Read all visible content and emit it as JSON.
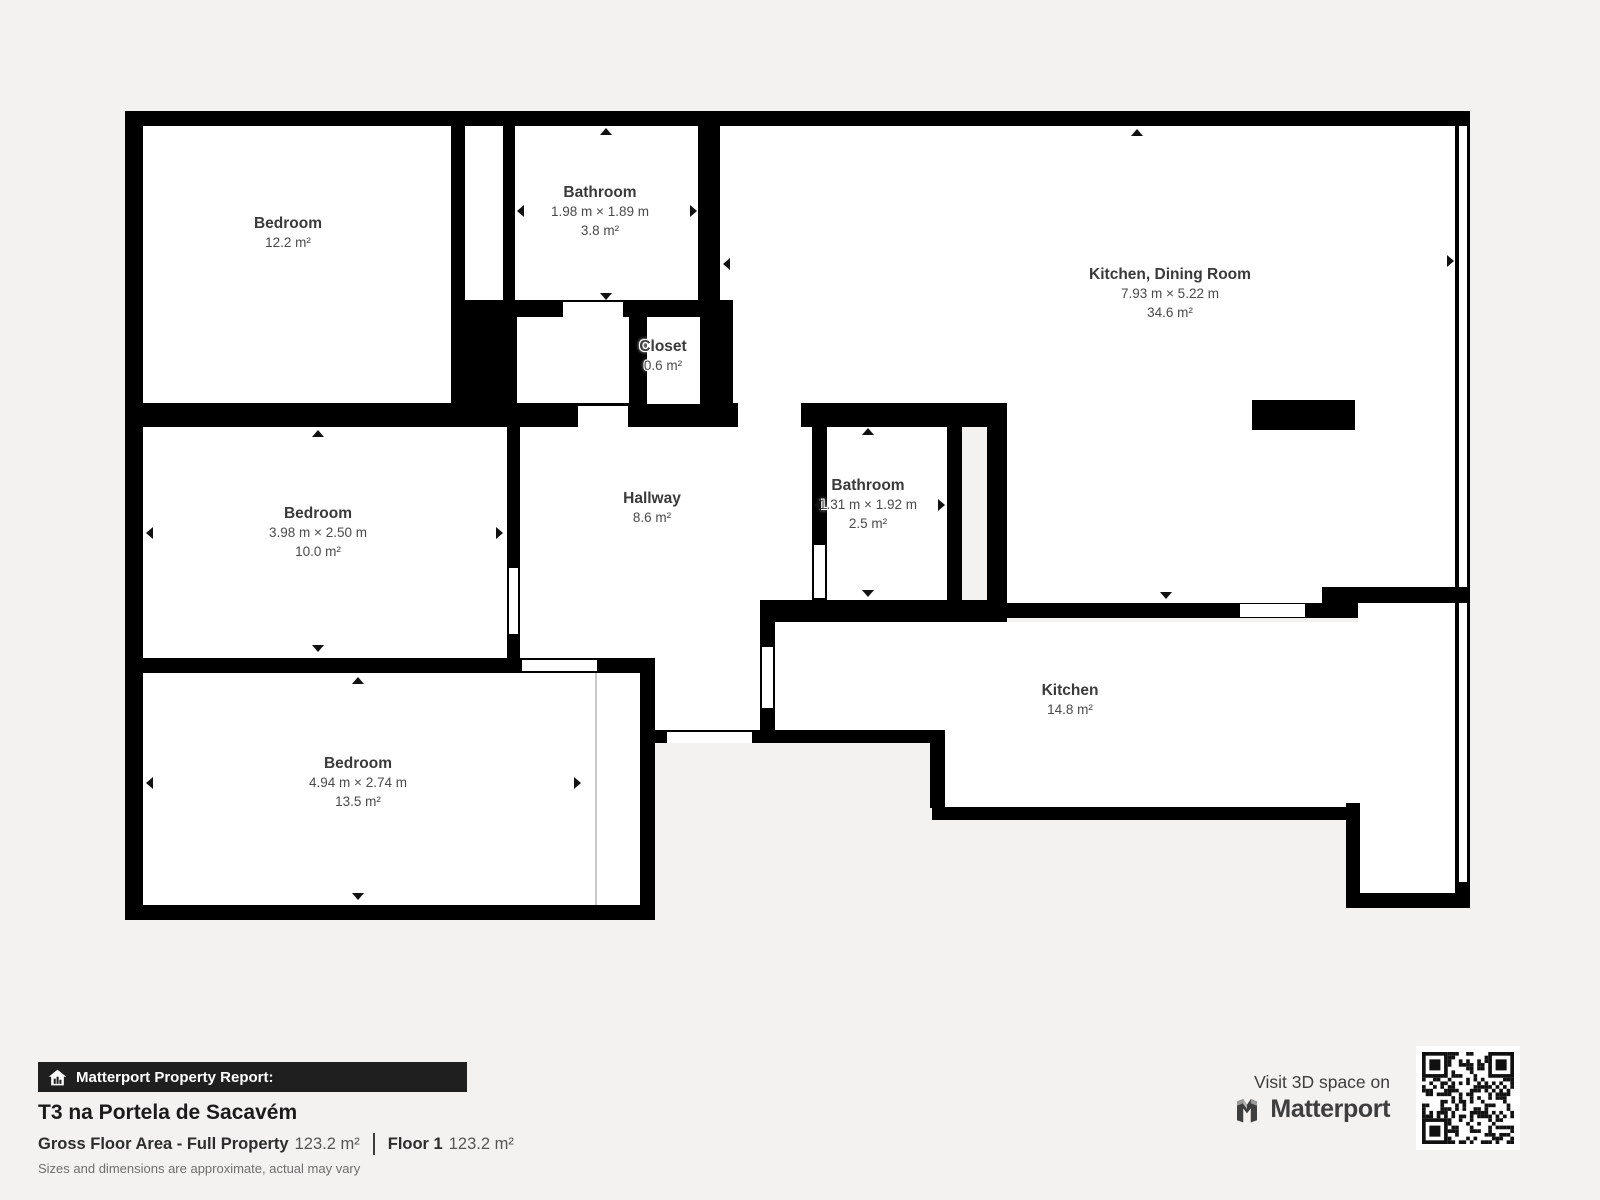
{
  "page": {
    "background": "#f3f2f0"
  },
  "floorplan": {
    "wall_color": "#000000",
    "room_color": "#ffffff",
    "partition_color": "#c9c9c9",
    "rooms": [
      [
        143,
        126,
        308,
        277
      ],
      [
        465,
        126,
        38,
        174
      ],
      [
        515,
        126,
        183,
        174
      ],
      [
        517,
        317,
        112,
        86
      ],
      [
        720,
        126,
        735,
        277
      ],
      [
        1007,
        403,
        448,
        200
      ],
      [
        143,
        427,
        364,
        231
      ],
      [
        520,
        427,
        292,
        173
      ],
      [
        520,
        600,
        240,
        58
      ],
      [
        655,
        658,
        105,
        72
      ],
      [
        827,
        427,
        120,
        173
      ],
      [
        143,
        673,
        497,
        232
      ],
      [
        775,
        622,
        680,
        108
      ],
      [
        945,
        730,
        510,
        77
      ],
      [
        1360,
        807,
        95,
        86
      ],
      [
        1358,
        602,
        97,
        20
      ],
      [
        1459,
        126,
        8,
        756
      ]
    ],
    "walls": [
      [
        125,
        111,
        1345,
        15
      ],
      [
        125,
        111,
        18,
        809
      ],
      [
        451,
        126,
        14,
        277
      ],
      [
        503,
        126,
        12,
        174
      ],
      [
        698,
        126,
        22,
        174
      ],
      [
        451,
        300,
        282,
        17
      ],
      [
        451,
        317,
        66,
        86
      ],
      [
        629,
        317,
        18,
        86
      ],
      [
        700,
        300,
        33,
        127
      ],
      [
        125,
        403,
        882,
        24
      ],
      [
        507,
        427,
        13,
        231
      ],
      [
        125,
        658,
        530,
        15
      ],
      [
        640,
        673,
        15,
        247
      ],
      [
        125,
        905,
        530,
        15
      ],
      [
        812,
        427,
        15,
        173
      ],
      [
        947,
        427,
        15,
        173
      ],
      [
        987,
        403,
        20,
        219
      ],
      [
        760,
        600,
        15,
        143
      ],
      [
        760,
        600,
        247,
        22
      ],
      [
        1007,
        603,
        351,
        15
      ],
      [
        1322,
        587,
        148,
        16
      ],
      [
        655,
        730,
        290,
        13
      ],
      [
        930,
        743,
        15,
        65
      ],
      [
        932,
        807,
        428,
        13
      ],
      [
        1346,
        803,
        14,
        92
      ],
      [
        1346,
        893,
        124,
        15
      ],
      [
        1455,
        126,
        4,
        756
      ],
      [
        1467,
        111,
        3,
        797
      ],
      [
        1455,
        882,
        15,
        26
      ]
    ],
    "openings": [
      [
        563,
        302,
        60,
        15
      ],
      [
        578,
        406,
        50,
        21
      ],
      [
        738,
        403,
        63,
        24
      ],
      [
        814,
        545,
        11,
        53
      ],
      [
        509,
        568,
        9,
        66
      ],
      [
        522,
        660,
        75,
        11
      ],
      [
        667,
        732,
        85,
        11
      ],
      [
        1240,
        604,
        65,
        13
      ],
      [
        647,
        317,
        53,
        87
      ],
      [
        762,
        647,
        11,
        61
      ]
    ],
    "counter": [
      1252,
      400,
      103,
      30
    ],
    "partition_line": [
      595,
      673,
      2,
      232
    ],
    "labels": [
      {
        "name": "Bedroom",
        "dims": "",
        "area": "12.2 m²",
        "x": 288,
        "y": 214
      },
      {
        "name": "Bathroom",
        "dims": "1.98 m × 1.89 m",
        "area": "3.8 m²",
        "x": 600,
        "y": 183
      },
      {
        "name": "Kitchen, Dining Room",
        "dims": "7.93 m × 5.22 m",
        "area": "34.6 m²",
        "x": 1170,
        "y": 265
      },
      {
        "name": "Closet",
        "dims": "",
        "area": "0.6 m²",
        "x": 663,
        "y": 337
      },
      {
        "name": "Bedroom",
        "dims": "3.98 m × 2.50 m",
        "area": "10.0 m²",
        "x": 318,
        "y": 504
      },
      {
        "name": "Hallway",
        "dims": "",
        "area": "8.6 m²",
        "x": 652,
        "y": 489
      },
      {
        "name": "Bathroom",
        "dims": "1.31 m × 1.92 m",
        "area": "2.5 m²",
        "x": 868,
        "y": 476
      },
      {
        "name": "Kitchen",
        "dims": "",
        "area": "14.8 m²",
        "x": 1070,
        "y": 681
      },
      {
        "name": "Bedroom",
        "dims": "4.94 m × 2.74 m",
        "area": "13.5 m²",
        "x": 358,
        "y": 754
      }
    ],
    "arrows": [
      {
        "d": "up",
        "x": 606,
        "y": 131
      },
      {
        "d": "down",
        "x": 606,
        "y": 296
      },
      {
        "d": "left",
        "x": 520,
        "y": 211
      },
      {
        "d": "right",
        "x": 693,
        "y": 211
      },
      {
        "d": "up",
        "x": 1137,
        "y": 132
      },
      {
        "d": "left",
        "x": 726,
        "y": 264
      },
      {
        "d": "right",
        "x": 1450,
        "y": 261
      },
      {
        "d": "down",
        "x": 1166,
        "y": 595
      },
      {
        "d": "up",
        "x": 318,
        "y": 433
      },
      {
        "d": "down",
        "x": 318,
        "y": 648
      },
      {
        "d": "left",
        "x": 149,
        "y": 533
      },
      {
        "d": "right",
        "x": 499,
        "y": 533
      },
      {
        "d": "up",
        "x": 868,
        "y": 431
      },
      {
        "d": "down",
        "x": 868,
        "y": 593
      },
      {
        "d": "left",
        "x": 817,
        "y": 505
      },
      {
        "d": "right",
        "x": 941,
        "y": 505
      },
      {
        "d": "up",
        "x": 358,
        "y": 680
      },
      {
        "d": "down",
        "x": 358,
        "y": 896
      },
      {
        "d": "left",
        "x": 149,
        "y": 783
      },
      {
        "d": "right",
        "x": 577,
        "y": 783
      }
    ]
  },
  "footer": {
    "bar_label": "Matterport Property Report:",
    "title": "T3 na Portela de Sacavém",
    "gfa_label": "Gross Floor Area - Full Property",
    "gfa_value": "123.2 m²",
    "floor_label": "Floor 1",
    "floor_value": "123.2 m²",
    "disclaimer": "Sizes and dimensions are approximate, actual may vary"
  },
  "branding": {
    "visit_text": "Visit 3D space on",
    "brand_name": "Matterport",
    "qr_icon": "qr-code",
    "logo_icon": "matterport-m-logo",
    "bar_icon": "house-report-icon",
    "bar_color": "#1f1f1f",
    "logo_color": "#3e3e3e"
  }
}
